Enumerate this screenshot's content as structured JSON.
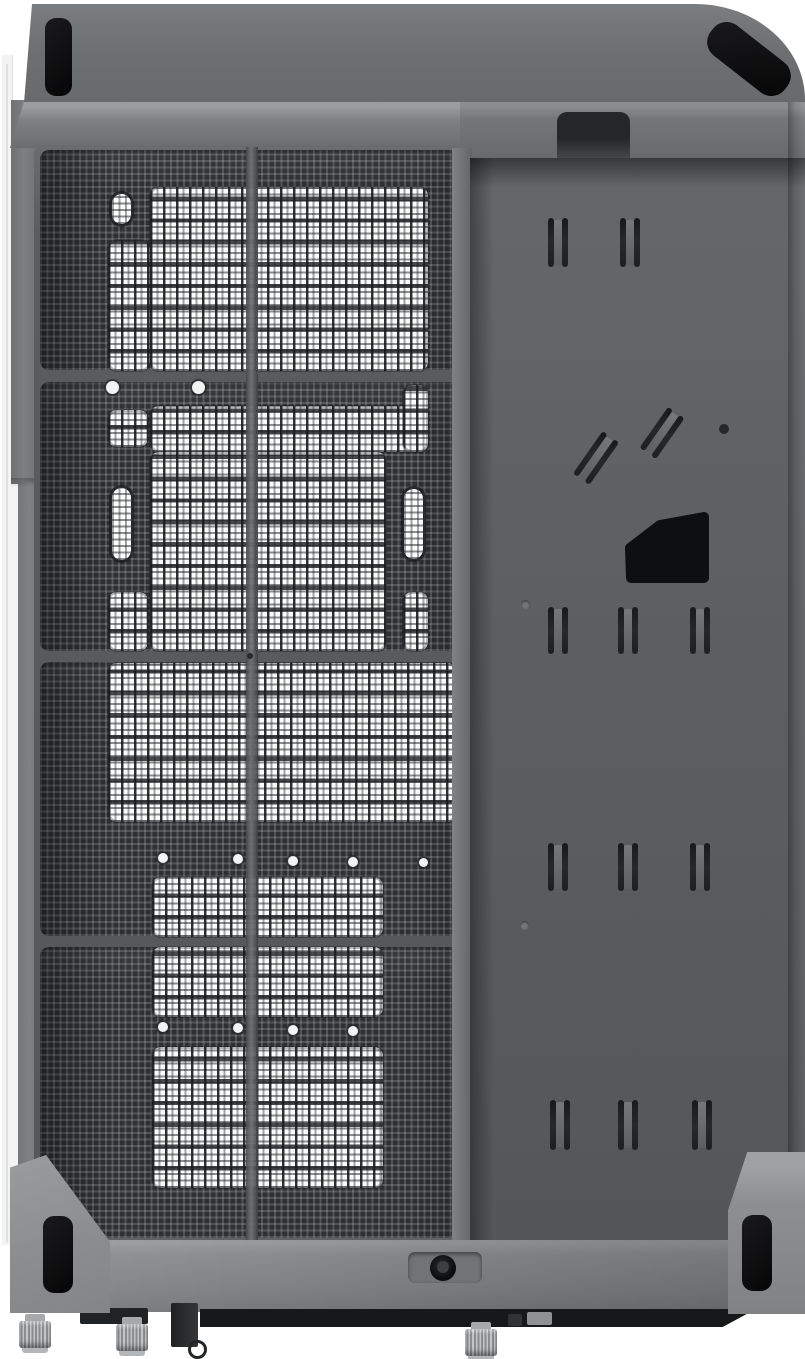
{
  "scene": {
    "type": "product-render",
    "description": "Studio render of a compact PC case lying on its side on a white background. Left two-thirds: dark fine-mesh panel divided into four sections with bright white perforated cutouts (fan openings, oblong handle slots, screw holes) showing through. Right third: flat gray steel tray panel with paired vent slots, two diagonal slot pairs, pilot holes and a black trapezoidal cable grommet. Chamfered gray top cover with black rubber pads at the corners; bottom edge with corner foot blocks, black rubber pads, a recessed round fastener and knurled metal thumbscrew feet.",
    "background_color": "#ffffff",
    "image_width_px": 805,
    "image_height_px": 1359,
    "visible_text": ""
  },
  "colors": {
    "c_bg": "#ffffff",
    "c_shell": "#f3f3f4",
    "c_seam": "#d7d8d9",
    "c_top1": "#7b7d7f",
    "c_top2": "#6b6d6f",
    "c_bevel_hi": "#9a9c9e",
    "c_frame": "#5a5c5e",
    "c_mesh_dark": "#2e3032",
    "c_white_mesh": "#fafbfb",
    "c_panel1": "#656769",
    "c_panel2": "#545658",
    "c_slot": "#1d1f21",
    "c_black": "#0c0c0d",
    "c_bottom": "#868889",
    "c_post": "#939597",
    "c_under": "#17181a",
    "c_metal": "#c2c4c6",
    "c_grommet": "#0e0f10"
  },
  "parts": {
    "case": "PC case product render",
    "shell_edge": "White outer shell edge seen side-on",
    "top_cover": "Chamfered gray top cover",
    "rubber_pad": "Black rubber pad",
    "notch": "Latch notch cutout in top cover",
    "mesh_panel": "Dark fine-mesh panel",
    "mesh_section": "Mesh panel section",
    "white_cutout": "White perforated shell visible through cutout",
    "handle_slot": "Oblong slot cutout",
    "screw_hole": "Screw hole",
    "divider": "Panel frame divider bar",
    "tray_panel": "Steel tray side panel",
    "vent_slot": "Vent slot pair",
    "diag_slot": "Diagonal vent slot pair",
    "pilot_hole": "Pilot hole",
    "grommet": "Black cable pass-through grommet",
    "bottom_edge": "Case bottom edge face",
    "recess_button": "Recessed round fastener",
    "corner_foot": "Corner foot block",
    "under_shadow": "Dark underside shadow",
    "bracket": "Metal bracket with pull ring",
    "thumbscrew": "Knurled thumbscrew foot"
  }
}
